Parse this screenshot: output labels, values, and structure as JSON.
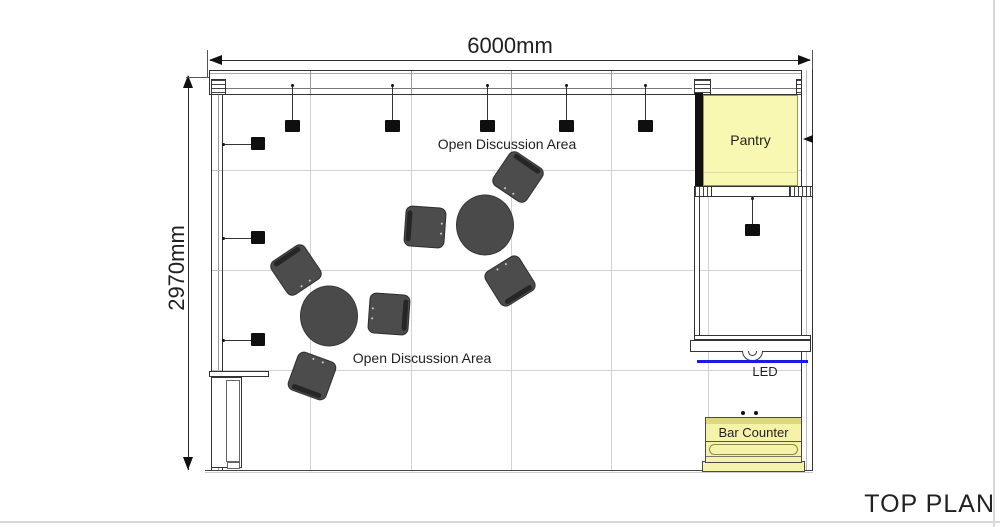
{
  "title": "TOP PLAN",
  "dimensions": {
    "width": "6000mm",
    "height": "2970mm"
  },
  "labels": {
    "open_discussion_top": "Open Discussion Area",
    "open_discussion_bottom": "Open Discussion Area",
    "pantry": "Pantry",
    "led": "LED",
    "bar_counter": "Bar Counter"
  },
  "colors": {
    "pantry_fill": "#f8f8b2",
    "bar_counter_fill": "#f6f2a8",
    "bar_counter_band": "#ddd783",
    "led_strip": "#1b1be0",
    "furniture_gray": "#4a4a4a",
    "wall_line": "#333333"
  },
  "fixtures": {
    "ceiling_lights_x": [
      292,
      392,
      487,
      566,
      645
    ],
    "wall_lights_y": [
      144,
      238,
      340
    ],
    "pendant_light": {
      "x": 752,
      "y": 197
    },
    "tables": [
      {
        "cx": 485,
        "cy": 225
      },
      {
        "cx": 329,
        "cy": 316
      }
    ],
    "chairs": [
      {
        "cx": 425,
        "cy": 227,
        "rot": 4,
        "back": "left"
      },
      {
        "cx": 518,
        "cy": 177,
        "rot": 34,
        "back": "top"
      },
      {
        "cx": 510,
        "cy": 281,
        "rot": -32,
        "back": "bottom"
      },
      {
        "cx": 296,
        "cy": 270,
        "rot": -34,
        "back": "top"
      },
      {
        "cx": 389,
        "cy": 314,
        "rot": 4,
        "back": "right"
      },
      {
        "cx": 312,
        "cy": 376,
        "rot": 20,
        "back": "bottom"
      }
    ],
    "floor_grid": {
      "vertical_x": [
        310,
        411,
        511,
        611,
        708
      ],
      "horizontal_y": [
        170,
        270,
        370
      ]
    }
  }
}
